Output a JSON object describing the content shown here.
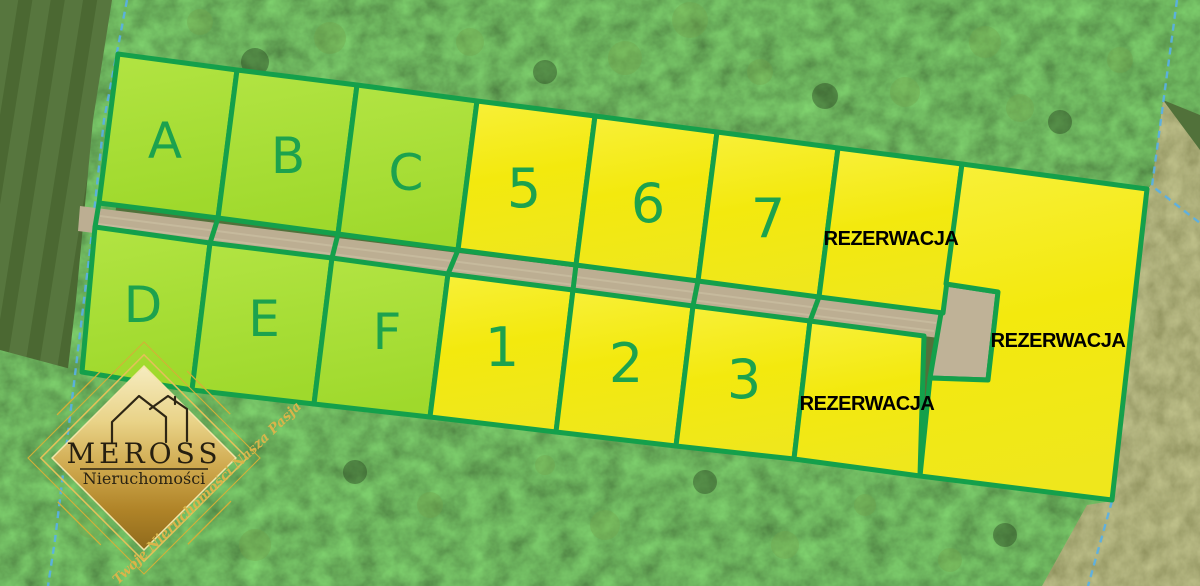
{
  "map_overlay": {
    "parcels": [
      {
        "label": "A",
        "zone": "green"
      },
      {
        "label": "B",
        "zone": "green"
      },
      {
        "label": "C",
        "zone": "green"
      },
      {
        "label": "5",
        "zone": "yellow"
      },
      {
        "label": "6",
        "zone": "yellow"
      },
      {
        "label": "7",
        "zone": "yellow"
      },
      {
        "label": "D",
        "zone": "green"
      },
      {
        "label": "E",
        "zone": "green"
      },
      {
        "label": "F",
        "zone": "green"
      },
      {
        "label": "1",
        "zone": "yellow"
      },
      {
        "label": "2",
        "zone": "yellow"
      },
      {
        "label": "3",
        "zone": "yellow"
      }
    ],
    "reservation_label": "REZERWACJA"
  },
  "logo": {
    "brand": "MEROSS",
    "subtitle": "Nieruchomości",
    "tagline": "Twoje Nieruchomości Nasza Pasja"
  },
  "colors": {
    "plot_border_green": "#14a04b",
    "plot_fill_green": "#a8df33",
    "plot_fill_yellow": "#f5ec16",
    "plot_label_green": "#1ca24e",
    "reservation_text": "#000000",
    "road_tan": "#bcae92",
    "cadastral_blue": "#58b0e8",
    "logo_gold": "#d4af37"
  }
}
